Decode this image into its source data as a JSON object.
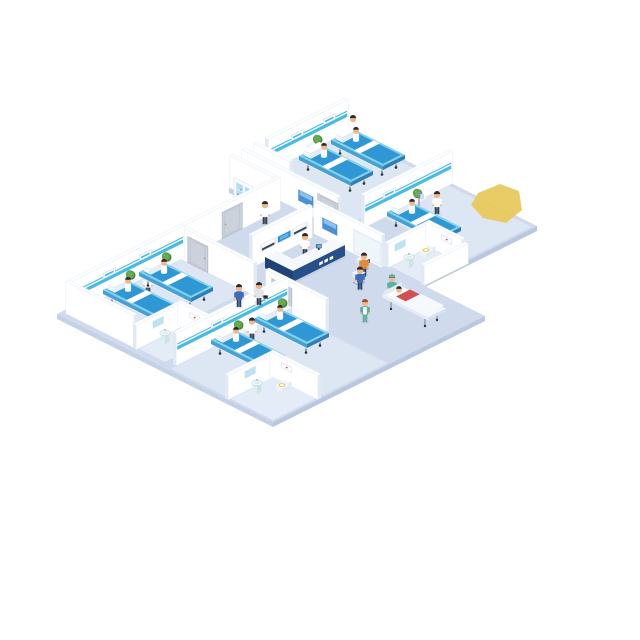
{
  "canvas": {
    "w": 640,
    "h": 640,
    "background": "#ffffff"
  },
  "palette": {
    "floor": "#cfdaed",
    "floorSideA": "#b9c7e0",
    "floorSideB": "#c4d0e7",
    "roomTint": "#dde7f4",
    "bathTint": "#e4edf7",
    "wall": "#ffffff",
    "wallTop": "#fdfeff",
    "wallCap": "#e2e9f3",
    "wallEdge": "#e5ecf4",
    "stripe": "#47bae6",
    "door": "#ccd2dc",
    "doorFrame": "#b2bac8",
    "poster": "#4a90d9",
    "posterHi": "#8cc0ec",
    "glass": "#eef5fb",
    "mirror": "#bfe2f2",
    "pictureDot": "#cf4a4a",
    "dispFrame": "#e2eaf3",
    "dispScreen": "#f7fafc",
    "dispDark": "#3c4856",
    "dispBlue": "#2f8fd8",
    "dispBlueHi": "#5db2e8",
    "bedTopRim": "#7ed2ee",
    "bedTop": "#2f98d4",
    "bedSideA": "#2e7fb4",
    "bedSideB": "#46a0d4",
    "frame": "#f3f7fb",
    "frameA": "#dbe4f0",
    "frameB": "#e8eff7",
    "leg": "#6b7686",
    "caster": "#2a2f36",
    "plantA": "#4a8540",
    "plantB": "#61a44e",
    "plantHi": "#79b863",
    "skin": "#f1b78c",
    "hairDark": "#2e2a28",
    "white": "#fbfcfe",
    "navy": "#27508a",
    "navyDark": "#1f4377",
    "kick": "#c7d4e6",
    "deskTop": "#f5f8fc",
    "monitor": "#2c3947",
    "kioskDark": "#2e3c4e",
    "kioskScreen": "#3fa5e6",
    "teal": "#58b2a3",
    "greenDress": "#5aab96",
    "redHair": "#a84a32",
    "blueTop": "#3d6db8",
    "bluePants": "#28456e",
    "orange": "#e08b3a",
    "darkPants": "#343f52",
    "greyTop": "#dfe6ee",
    "case": "#23282e",
    "cabGlass": "#b0dff2",
    "seat": "#e3cc4a",
    "sinkBody": "#eaf4f6",
    "sinkSideA": "#cfe2e6",
    "sinkSideB": "#ddeef0",
    "bowlRim": "#c9dfe4",
    "bowlIn": "#d9eef2",
    "gurneyTop": "#f4f7fb",
    "gurneySideA": "#d9e2ee",
    "gurneySideB": "#e6edf6",
    "sheet": "#f6f9fc",
    "patientRed": "#d25050",
    "blob": "#e9c95e",
    "shadow": "#2a3a5a"
  },
  "scene": {
    "origin": {
      "x": 345,
      "y": 130
    },
    "elements": [
      {
        "t": "slab",
        "n": "floor-upper",
        "a0": 0,
        "b0": 0,
        "a1": 96,
        "b1": 58
      },
      {
        "t": "slab",
        "n": "floor-lower",
        "a0": 20,
        "b0": 58,
        "a1": 128,
        "b1": 164
      },
      {
        "t": "tint",
        "n": "room-floor-top-ward",
        "a0": 2,
        "b0": 2,
        "a1": 48,
        "b1": 43,
        "c": "roomTint"
      },
      {
        "t": "tint",
        "n": "room-floor-right-ward",
        "a0": 54,
        "b0": 2,
        "a1": 95,
        "b1": 34,
        "c": "roomTint"
      },
      {
        "t": "tint",
        "n": "room-floor-left-ward",
        "a0": 24,
        "b0": 106,
        "a1": 56,
        "b1": 159,
        "c": "roomTint"
      },
      {
        "t": "tint",
        "n": "room-floor-bottom-ward",
        "a0": 76,
        "b0": 106,
        "a1": 127,
        "b1": 163,
        "c": "roomTint"
      },
      {
        "t": "tint",
        "n": "room-floor-bath-right",
        "a0": 80,
        "b0": 38,
        "a1": 95,
        "b1": 57,
        "c": "bathTint"
      },
      {
        "t": "tint",
        "n": "room-floor-bath-mid",
        "a0": 58,
        "b0": 140,
        "a1": 71,
        "b1": 161,
        "c": "bathTint"
      },
      {
        "t": "tint",
        "n": "room-floor-bath-bottom",
        "a0": 106,
        "b0": 142,
        "a1": 127,
        "b1": 163,
        "c": "bathTint"
      },
      {
        "t": "blob",
        "n": "yellow-cropped-shape",
        "pts": [
          [
            478,
            193
          ],
          [
            500,
            184
          ],
          [
            519,
            191
          ],
          [
            522,
            210
          ],
          [
            506,
            223
          ],
          [
            483,
            218
          ],
          [
            471,
            205
          ]
        ]
      },
      {
        "t": "wallR",
        "n": "wall-top-ward-back",
        "a": 0,
        "b0": 0,
        "b1": 40,
        "h": 32,
        "stripe": true,
        "items": [
          {
            "k": "sign",
            "at": 6.5
          },
          {
            "k": "sign",
            "at": 22.5
          }
        ]
      },
      {
        "t": "person",
        "n": "nurse-top-ward",
        "a": 6,
        "b": 2,
        "top": "white"
      },
      {
        "t": "plant",
        "n": "plant-top-ward",
        "a": 4,
        "b": 18
      },
      {
        "t": "bed",
        "n": "bed-top-ward-right",
        "a": 8,
        "b": 4,
        "p": true
      },
      {
        "t": "bed",
        "n": "bed-top-ward-left",
        "a": 8,
        "b": 20,
        "p": true
      },
      {
        "t": "wallL",
        "n": "wall-top-ward-side",
        "b": 44,
        "a0": 0,
        "a1": 18,
        "h": 32
      },
      {
        "t": "wallR",
        "n": "wall-right-ward-back",
        "a": 52,
        "b0": 0,
        "b1": 44,
        "h": 32,
        "stripe": true,
        "items": [
          {
            "k": "sign",
            "at": 28.5
          }
        ]
      },
      {
        "t": "plant",
        "n": "plant-right-ward",
        "a": 56,
        "b": 20
      },
      {
        "t": "iv",
        "n": "iv-stand",
        "a": 60,
        "b": 23
      },
      {
        "t": "person",
        "n": "nurse-right-ward",
        "a": 65,
        "b": 19,
        "top": "white"
      },
      {
        "t": "bed",
        "n": "bed-right-ward",
        "a": 58,
        "b": 26,
        "p": true
      },
      {
        "t": "wallL",
        "n": "wall-corridor-top",
        "b": 50,
        "a0": 0,
        "a1": 48,
        "h": 32,
        "items": [
          {
            "k": "poster",
            "at": 28
          },
          {
            "k": "door",
            "at": 38
          }
        ]
      },
      {
        "t": "wallL",
        "n": "wall-supply-room",
        "b": 56,
        "a0": 0,
        "a1": 22,
        "h": 32
      },
      {
        "t": "cabinet",
        "n": "supply-cabinet",
        "a0": 8,
        "b0": 58,
        "a1": 18,
        "b1": 63.5,
        "h": 24
      },
      {
        "t": "wallR",
        "n": "wall-center-left",
        "a": 22,
        "b0": 56,
        "b1": 104,
        "h": 32,
        "items": [
          {
            "k": "door",
            "at": 75
          }
        ]
      },
      {
        "t": "wallR",
        "n": "wall-reception-back",
        "a": 44,
        "b0": 62,
        "b1": 92,
        "h": 32,
        "items": [
          {
            "k": "displays",
            "at": [
              68,
              76,
              84
            ]
          }
        ]
      },
      {
        "t": "wallL",
        "n": "wall-hall-right",
        "b": 58,
        "a0": 44,
        "a1": 78,
        "h": 32,
        "items": [
          {
            "k": "poster",
            "at": 48
          },
          {
            "k": "glass",
            "at": 64,
            "w": 13.5
          }
        ]
      },
      {
        "t": "person",
        "n": "nurse-corridor",
        "a": 27,
        "b": 67,
        "top": "white"
      },
      {
        "t": "person",
        "n": "receptionist",
        "a": 53,
        "b": 73,
        "top": "white"
      },
      {
        "t": "desk",
        "n": "reception-desk",
        "wingB": [
          58,
          64,
          64,
          90
        ],
        "wingA": [
          50,
          84,
          64,
          90
        ],
        "h": 13,
        "marks": [
          70,
          72.6,
          75.2
        ],
        "monitor": [
          60,
          73
        ]
      },
      {
        "t": "kiosk",
        "n": "checkin-kiosk-1",
        "a": 74,
        "b": 65
      },
      {
        "t": "person",
        "n": "kiosk-user-1",
        "a": 77.5,
        "b": 68,
        "top": "orange"
      },
      {
        "t": "kiosk",
        "n": "checkin-kiosk-2",
        "a": 80,
        "b": 73
      },
      {
        "t": "person",
        "n": "kiosk-user-2",
        "a": 83.5,
        "b": 76,
        "top": "blueTop",
        "pants": "bluePants"
      },
      {
        "t": "wallR",
        "n": "wall-bath-right-back",
        "a": 78,
        "b0": 36,
        "b1": 58,
        "h": 24,
        "items": [
          {
            "k": "mirror",
            "at": 49
          }
        ]
      },
      {
        "t": "wallL",
        "n": "wall-bath-right-side",
        "b": 36,
        "a0": 78,
        "a1": 96,
        "h": 24,
        "items": [
          {
            "k": "picture",
            "at": 86
          }
        ]
      },
      {
        "t": "sink",
        "n": "sink-bath-right",
        "a": 84,
        "b": 52
      },
      {
        "t": "toilet",
        "n": "toilet-bath-right",
        "a": 82.5,
        "b": 42,
        "dir": "b"
      },
      {
        "t": "wallR",
        "n": "wall-right-edge",
        "a": 96,
        "b0": 36,
        "b1": 58,
        "h": 20
      },
      {
        "t": "person",
        "n": "orderly-gurney",
        "a": 95.5,
        "b": 72,
        "top": "teal",
        "pants": "teal",
        "cap": "teal"
      },
      {
        "t": "gurney",
        "n": "patient-gurney",
        "a": 98,
        "b": 70.5
      },
      {
        "t": "person",
        "n": "nurse-hall",
        "a": 101,
        "b": 91,
        "top": "greenDress",
        "pants": "greenDress",
        "hair": "redHair",
        "apron": true
      },
      {
        "t": "wallL",
        "n": "wall-hall-front-left",
        "b": 104,
        "a0": 22,
        "a1": 60,
        "h": 32,
        "items": [
          {
            "k": "door",
            "at": 27
          }
        ]
      },
      {
        "t": "wallL",
        "n": "wall-hall-front-right",
        "b": 104,
        "a0": 66,
        "a1": 96,
        "h": 32,
        "items": [
          {
            "k": "door",
            "at": 69
          }
        ]
      },
      {
        "t": "wallR",
        "n": "wall-left-ward-back",
        "a": 22,
        "b0": 104,
        "b1": 160,
        "h": 32,
        "stripe": true,
        "items": [
          {
            "k": "sign",
            "at": 120.5
          },
          {
            "k": "sign",
            "at": 138.5
          }
        ]
      },
      {
        "t": "plant",
        "n": "plant-left-ward-1",
        "a": 25,
        "b": 114.5
      },
      {
        "t": "plant",
        "n": "plant-left-ward-2",
        "a": 25,
        "b": 132.5
      },
      {
        "t": "person",
        "n": "nurse-left-ward",
        "a": 33,
        "b": 131.5,
        "top": "white"
      },
      {
        "t": "bed",
        "n": "bed-left-ward-right",
        "a": 26,
        "b": 118,
        "p": true
      },
      {
        "t": "bed",
        "n": "bed-left-ward-left",
        "a": 26,
        "b": 136,
        "p": true
      },
      {
        "t": "wallL",
        "n": "wall-left-ward-front",
        "b": 160,
        "a0": 22,
        "a1": 56,
        "h": 32
      },
      {
        "t": "wallR",
        "n": "wall-bath-mid-back",
        "a": 56,
        "b0": 138,
        "b1": 162,
        "h": 24,
        "items": [
          {
            "k": "mirror",
            "at": 148
          }
        ]
      },
      {
        "t": "wallL",
        "n": "wall-bath-mid-side",
        "b": 138,
        "a0": 56,
        "a1": 72,
        "h": 24,
        "items": [
          {
            "k": "picture",
            "at": 62
          }
        ]
      },
      {
        "t": "sink",
        "n": "sink-bath-mid",
        "a": 61,
        "b": 151
      },
      {
        "t": "toilet",
        "n": "toilet-bath-mid",
        "a": 66,
        "b": 143.5,
        "dir": "b"
      },
      {
        "t": "wallR",
        "n": "wall-bottom-ward-back",
        "a": 74,
        "b0": 104,
        "b1": 160,
        "h": 32,
        "stripe": true,
        "items": [
          {
            "k": "sign",
            "at": 114.5
          },
          {
            "k": "sign",
            "at": 136.5
          }
        ]
      },
      {
        "t": "plant",
        "n": "plant-bottom-ward-1",
        "a": 77,
        "b": 108.5
      },
      {
        "t": "plant",
        "n": "plant-bottom-ward-2",
        "a": 77,
        "b": 130.5
      },
      {
        "t": "person",
        "n": "nurse-bottom-ward",
        "a": 82,
        "b": 128.5,
        "top": "white"
      },
      {
        "t": "bed",
        "n": "bed-bottom-ward-right",
        "a": 78,
        "b": 112,
        "p": true
      },
      {
        "t": "bed",
        "n": "bed-bottom-ward-left",
        "a": 78,
        "b": 134,
        "p": true
      },
      {
        "t": "person",
        "n": "doctor-hall",
        "a": 66,
        "b": 109,
        "top": "greyTop",
        "case": true
      },
      {
        "t": "person",
        "n": "visitor-hall",
        "a": 62,
        "b": 115,
        "top": "blueTop",
        "pants": "bluePants"
      },
      {
        "t": "wallR",
        "n": "wall-bath-bottom-back",
        "a": 104,
        "b0": 140,
        "b1": 164,
        "h": 24,
        "items": [
          {
            "k": "mirror",
            "at": 150
          }
        ]
      },
      {
        "t": "wallL",
        "n": "wall-bath-bottom-side",
        "b": 140,
        "a0": 104,
        "a1": 128,
        "h": 24,
        "items": [
          {
            "k": "picture",
            "at": 110
          }
        ]
      },
      {
        "t": "sink",
        "n": "sink-bath-bottom",
        "a": 109,
        "b": 153
      },
      {
        "t": "toilet",
        "n": "toilet-bath-bottom",
        "a": 114,
        "b": 145.5,
        "dir": "b"
      }
    ]
  }
}
